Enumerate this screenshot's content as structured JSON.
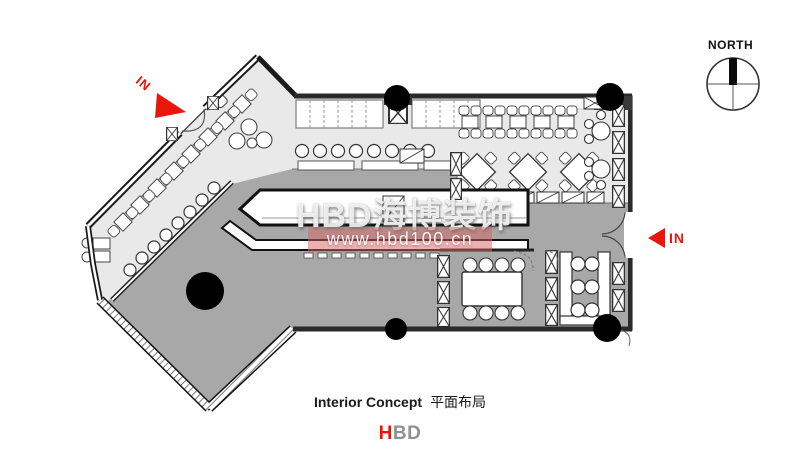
{
  "compass": {
    "label": "NORTH"
  },
  "entrance_left": {
    "label": "IN"
  },
  "entrance_right": {
    "label": "IN"
  },
  "watermark": {
    "brand": "HBD海博装饰",
    "url": "www.hbd100.cn"
  },
  "caption": {
    "en": "Interior Concept",
    "zh": "平面布局"
  },
  "logo": {
    "red": "H",
    "gray": "BD"
  },
  "colors": {
    "accent_red": "#e8160c",
    "floor_light": "#e9e9e9",
    "floor_dark": "#a8a8a8",
    "wall": "#222222",
    "furniture_fill": "#ffffff",
    "logo_gray": "#8d9094",
    "watermark_band": "rgba(214,99,99,0.5)"
  }
}
